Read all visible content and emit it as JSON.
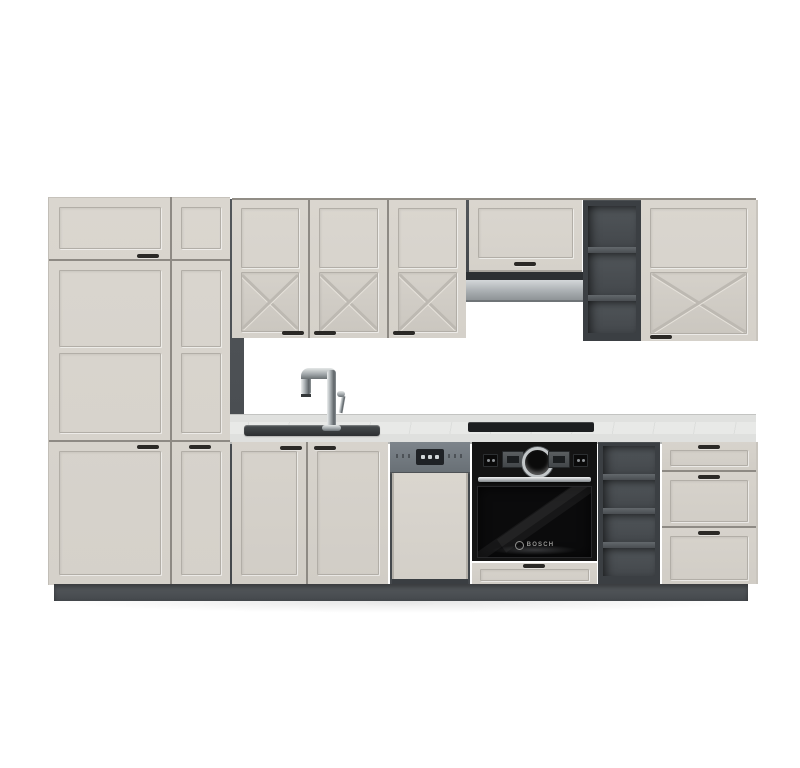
{
  "scene": {
    "title": "Kitchen cabinet set product photo",
    "background_color": "#ffffff"
  },
  "palette": {
    "cabinet_front": "#d8d4cd",
    "cabinet_groove": "#b2aea7",
    "carcass_dark": "#42464a",
    "shelf_interior": "#4b5054",
    "plinth": "#4c5054",
    "countertop": "#e8e9e7",
    "counter_edge": "#dfe0de",
    "stainless_hood": "#b7bcbe",
    "oven_black": "#141414",
    "dishwasher_panel": "#757c83",
    "handle": "#2b2926",
    "chrome_faucet": "#c9cdcf",
    "cooktop": "#1c1e20"
  },
  "oven": {
    "brand": "BOSCH"
  },
  "components": {
    "tall_cabinet_wide": "tall pantry cabinet with 3 framed doors",
    "tall_cabinet_narrow": "narrow tall cabinet with 3 framed doors",
    "wall_cabinets": "three wall doors with cross panel detail",
    "hood_cabinet": "short wall cabinet above extractor hood",
    "extractor_hood": "telescopic stainless steel hood",
    "wall_open_shelf": "open wall shelf unit, 3 compartments",
    "wall_cabinet_right": "wide wall cabinet with cross panel",
    "sink": "inset sink with chrome mixer tap",
    "sink_base_cabinet": "two-door sink base cabinet",
    "dishwasher": "semi-integrated dishwasher with grey control panel",
    "built_in_oven": "black built-in oven",
    "cooktop": "black built-in hob",
    "base_open_shelf": "open base shelf unit, 4 compartments",
    "drawer_unit": "base cabinet with 3 drawers",
    "plinth": "anthracite plinth"
  }
}
